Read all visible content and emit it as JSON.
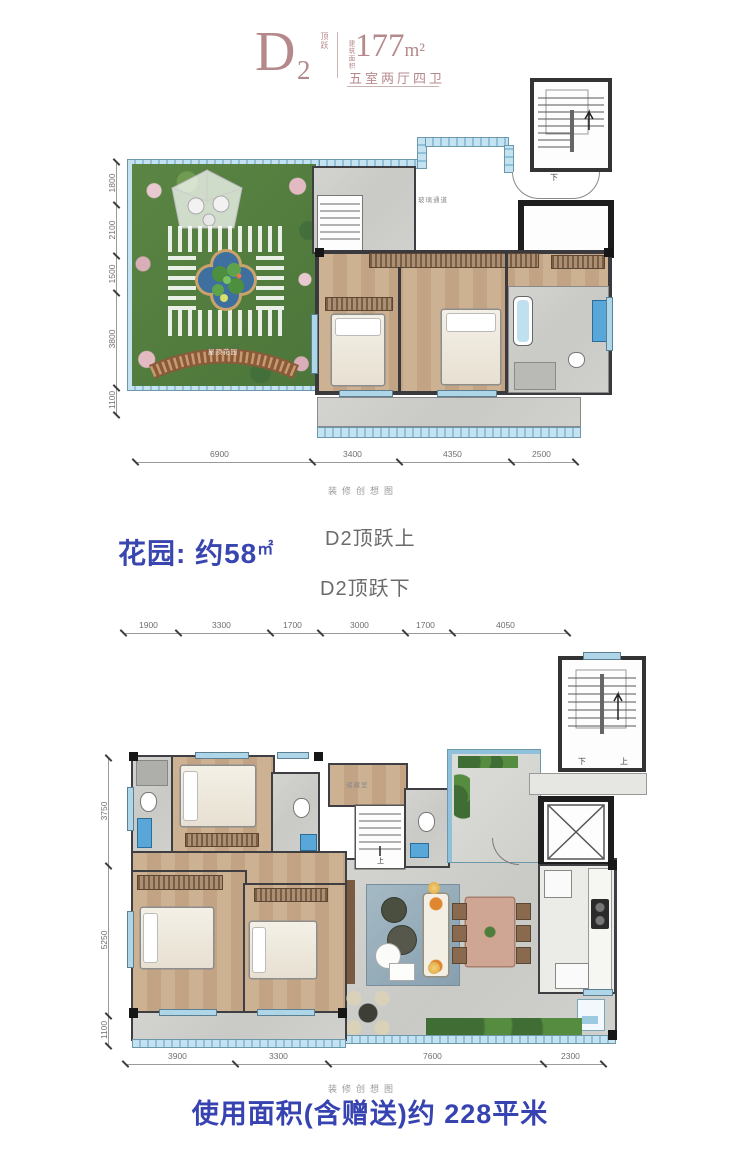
{
  "header": {
    "plan_letter": "D",
    "plan_number": "2",
    "plan_tag": "顶跃",
    "area_caption": "建筑面积",
    "area_value": "177",
    "area_unit": "m²",
    "layout_text": "五室两厅四卫"
  },
  "upper_plan": {
    "dims_left": [
      "1800",
      "2100",
      "1500",
      "3800",
      "1100"
    ],
    "dims_bottom": [
      "6900",
      "3400",
      "4350",
      "2500"
    ],
    "caption": "装修创想图",
    "garden_label": "屋顶花园",
    "corridor_label": "玻璃通道",
    "stair_label_down": "下"
  },
  "middle": {
    "garden_area_text": "花园: 约58",
    "garden_area_unit": "㎡",
    "upper_label": "D2顶跃上",
    "lower_label": "D2顶跃下"
  },
  "lower_plan": {
    "dims_top": [
      "1900",
      "3300",
      "1700",
      "3000",
      "1700",
      "4050"
    ],
    "dims_left": [
      "3750",
      "5250",
      "1100"
    ],
    "dims_bottom": [
      "3900",
      "3300",
      "7600",
      "2300"
    ],
    "caption": "装修创想图",
    "storage_label": "储藏室",
    "inner_stair_label": "上",
    "stair_label_down": "下",
    "stair_label_up": "上"
  },
  "footer": {
    "usable_area_text": "使用面积(含赠送)约 228平米"
  },
  "colors": {
    "accent_blue": "#3a46b0",
    "header_rose": "#b5898b",
    "window_blue": "#aed6e8",
    "wall_dark": "#3a3a3e"
  }
}
